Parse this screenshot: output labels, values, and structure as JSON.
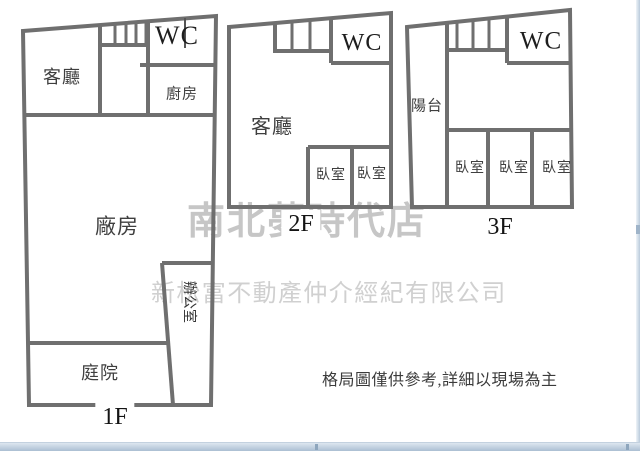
{
  "floors": {
    "f1": {
      "floor_label": "1F",
      "living": "客廳",
      "kitchen": "廚房",
      "wc": "WC",
      "factory": "廠房",
      "office": "辦公室",
      "yard": "庭院"
    },
    "f2": {
      "floor_label": "2F",
      "living": "客廳",
      "wc": "WC",
      "bedroom1": "臥室",
      "bedroom2": "臥室"
    },
    "f3": {
      "floor_label": "3F",
      "balcony": "陽台",
      "wc": "WC",
      "bedroom1": "臥室",
      "bedroom2": "臥室",
      "bedroom3": "臥室"
    }
  },
  "watermarks": {
    "store": "南北夢時代店",
    "company": "新松富不動產仲介經紀有限公司"
  },
  "note": "格局圖僅供參考,詳細以現場為主",
  "colors": {
    "wall": "#6f6f6f",
    "watermark_store": "#c6c6c6",
    "watermark_company": "#d0d0d0",
    "scrollbar": "#b9cadb"
  }
}
